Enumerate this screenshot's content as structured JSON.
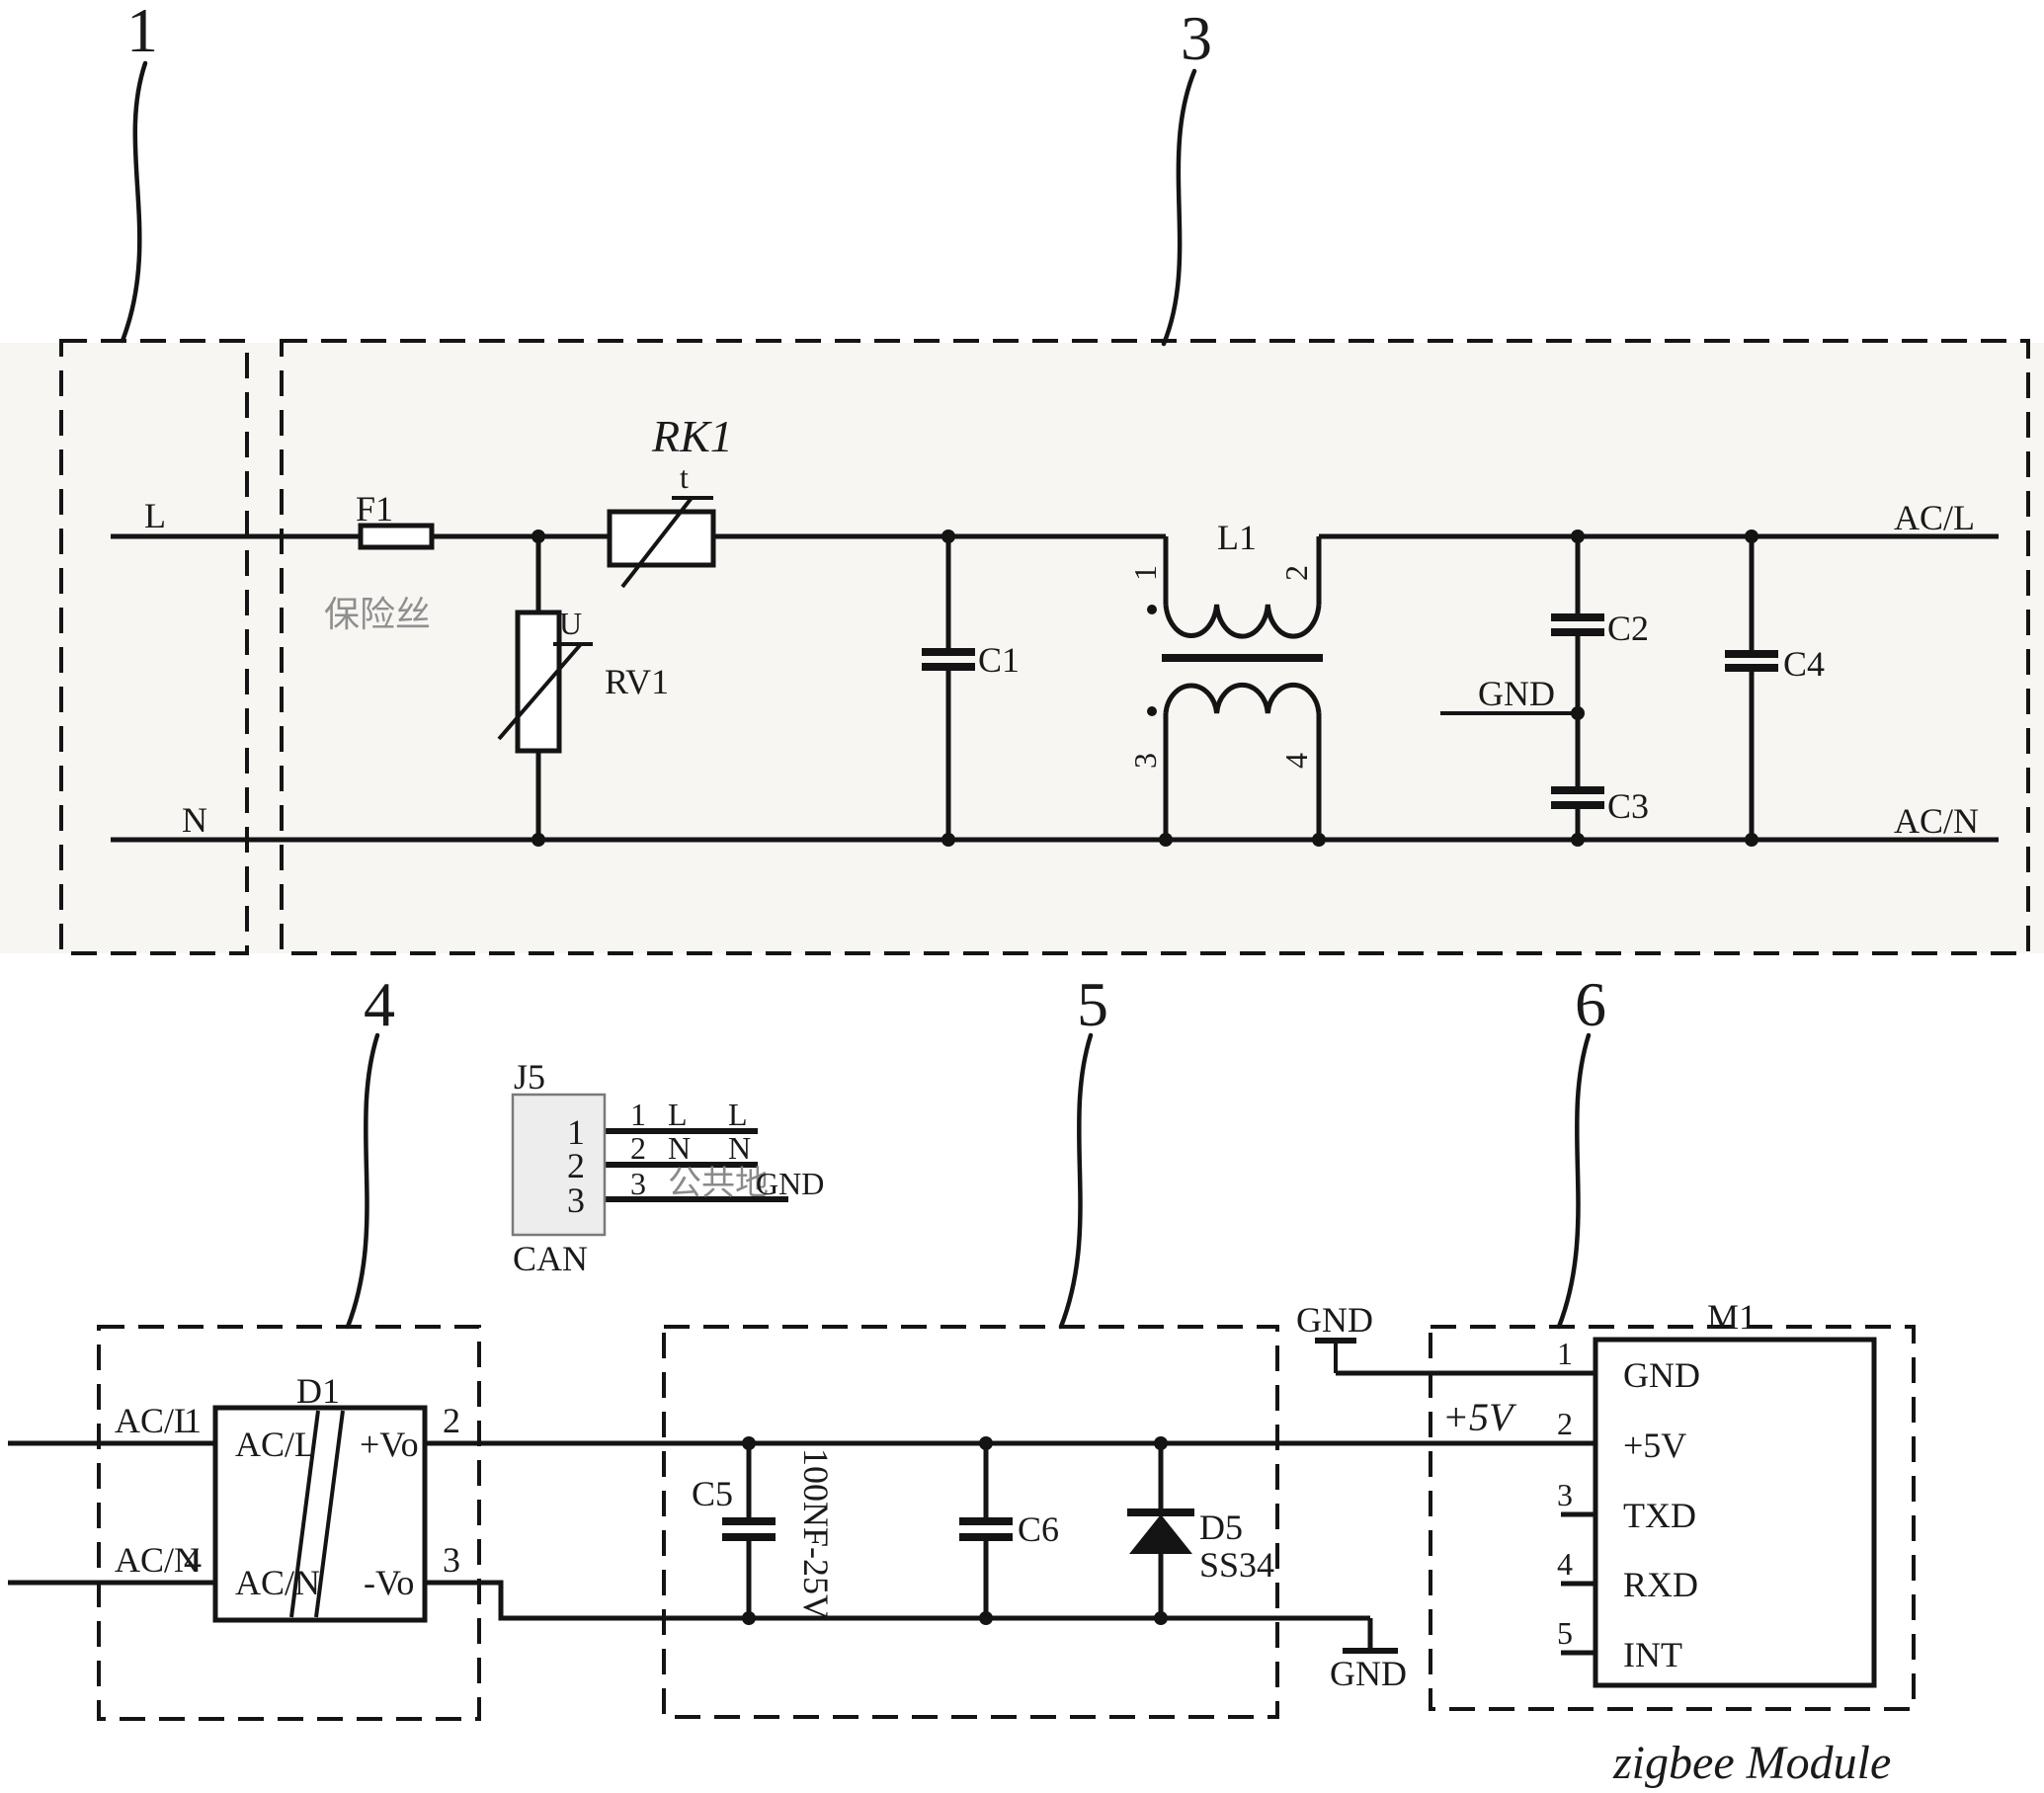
{
  "colors": {
    "ink": "#141414",
    "faded_label": "#8f8f8f",
    "band": "#f7f6f3",
    "connector_fill": "#ededed"
  },
  "callouts": {
    "b1": "1",
    "b3": "3",
    "b4": "4",
    "b5": "5",
    "b6": "6"
  },
  "emi": {
    "l": "L",
    "n": "N",
    "acl": "AC/L",
    "acn": "AC/N",
    "gnd": "GND",
    "f1": {
      "ref": "F1",
      "cn": "保险丝"
    },
    "rv1": {
      "ref": "RV1",
      "sym": "U"
    },
    "rk1": {
      "ref": "RK1",
      "sym": "t"
    },
    "c1": "C1",
    "c2": "C2",
    "c3": "C3",
    "c4": "C4",
    "l1": {
      "ref": "L1",
      "p1": "1",
      "p2": "2",
      "p3": "3",
      "p4": "4"
    }
  },
  "j5": {
    "ref": "J5",
    "name": "CAN",
    "pin1": "1",
    "pin2": "2",
    "pin3": "3",
    "row1": {
      "num": "1",
      "sig": "L",
      "net": "L"
    },
    "row2": {
      "num": "2",
      "sig": "N",
      "net": "N"
    },
    "row3": {
      "num": "3",
      "sig": "公共地",
      "net": "GND"
    }
  },
  "psu": {
    "ref": "D1",
    "in_top": {
      "name": "AC/L",
      "num": "1"
    },
    "in_bot": {
      "name": "AC/N",
      "num": "4"
    },
    "out_top": {
      "name": "+Vo",
      "num": "2"
    },
    "out_bot": {
      "name": "-Vo",
      "num": "3"
    },
    "port_tl": "AC/L",
    "port_bl": "AC/N",
    "port_tr": "+Vo",
    "port_br": "-Vo"
  },
  "filter": {
    "c5": "C5",
    "c5_value": "100NF-25V",
    "c6": "C6",
    "d5": "D5",
    "d5_part": "SS34",
    "gnd": "GND"
  },
  "mcu": {
    "ref": "M1",
    "caption": "zigbee Module",
    "v5": "+5V",
    "gnd": "GND",
    "p1": {
      "num": "1",
      "name": "GND"
    },
    "p2": {
      "num": "2",
      "name": "+5V"
    },
    "p3": {
      "num": "3",
      "name": "TXD"
    },
    "p4": {
      "num": "4",
      "name": "RXD"
    },
    "p5": {
      "num": "5",
      "name": "INT"
    }
  }
}
